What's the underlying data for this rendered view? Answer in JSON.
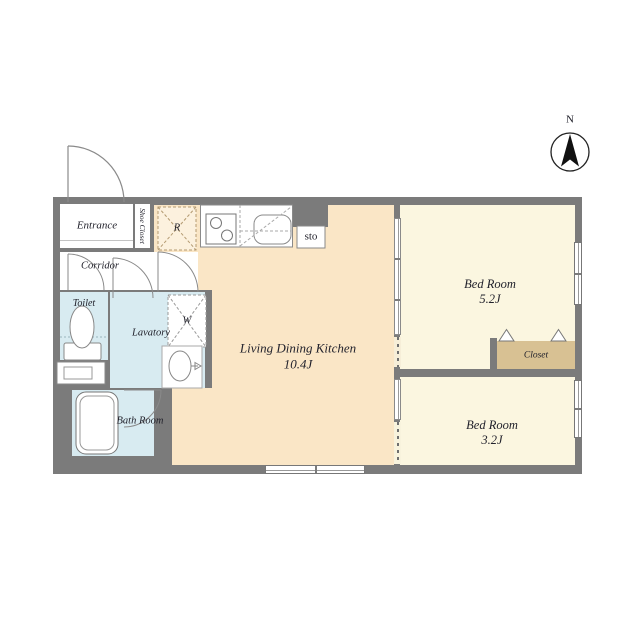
{
  "compass": {
    "label": "N"
  },
  "colors": {
    "wall": "#7b7b7b",
    "ldk_floor": "#fae6c6",
    "bedroom_floor": "#fbf6e0",
    "wet_area_floor": "#d8ebf1",
    "closet_floor": "#d8c193"
  },
  "rooms": {
    "entrance": {
      "label": "Entrance"
    },
    "shoe_closet": {
      "label": "Shoe Closet"
    },
    "corridor": {
      "label": "Corridor"
    },
    "toilet": {
      "label": "Toilet"
    },
    "lavatory": {
      "label": "Lavatory"
    },
    "bath_room": {
      "label": "Bath Room"
    },
    "ldk": {
      "label": "Living Dining Kitchen",
      "size": "10.4J"
    },
    "bedroom_1": {
      "label": "Bed Room",
      "size": "5.2J"
    },
    "bedroom_2": {
      "label": "Bed Room",
      "size": "3.2J"
    },
    "closet": {
      "label": "Closet"
    },
    "storage": {
      "label": "sto"
    }
  },
  "fixtures": {
    "refrigerator": {
      "label": "R"
    },
    "washing_machine": {
      "label": "W"
    }
  }
}
